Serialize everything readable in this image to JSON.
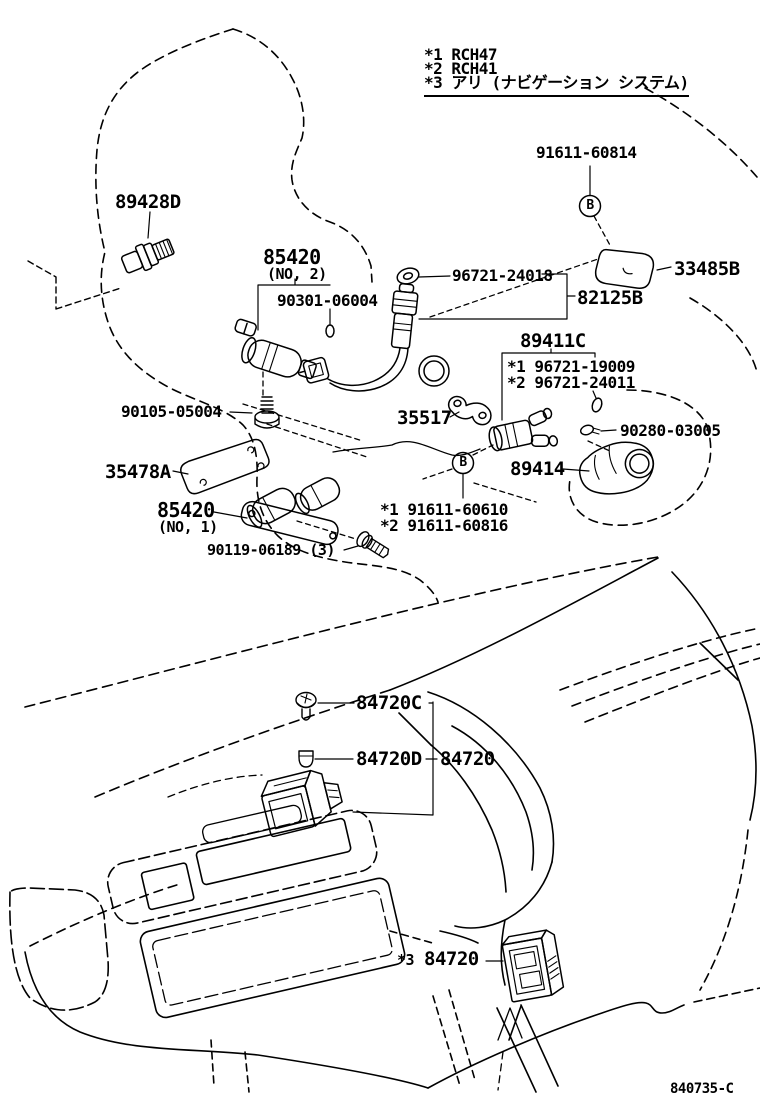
{
  "colors": {
    "line": "#000000",
    "background": "#ffffff"
  },
  "legend": {
    "note1": "*1 RCH47",
    "note2": "*2 RCH41",
    "note3": "*3 アリ (ナビゲーション システム)"
  },
  "drawing_number": "840735-C",
  "markers": {
    "b1": "B",
    "b2": "B"
  },
  "callouts": {
    "c89428d": "89428D",
    "c91611_60814": "91611-60814",
    "c33485b": "33485B",
    "c96721_24018": "96721-24018",
    "c82125b": "82125B",
    "c85420_no2": "85420",
    "c85420_no2_sub": "(NO, 2)",
    "c90301_06004": "90301-06004",
    "c90105_05004": "90105-05004",
    "c35517": "35517",
    "c89411c": "89411C",
    "c89411c_var1": "*1 96721-19009",
    "c89411c_var2": "*2 96721-24011",
    "c90280_03005": "90280-03005",
    "c89414": "89414",
    "c35478a": "35478A",
    "c85420_no1": "85420",
    "c85420_no1_sub": "(NO, 1)",
    "c91611_var1": "*1 91611-60610",
    "c91611_var2": "*2 91611-60816",
    "c90119_06189": "90119-06189 (3)",
    "c84720c": "84720C",
    "c84720d": "84720D",
    "c84720": "84720",
    "c84720_bottom_prefix": "*3",
    "c84720_bottom": "84720"
  }
}
